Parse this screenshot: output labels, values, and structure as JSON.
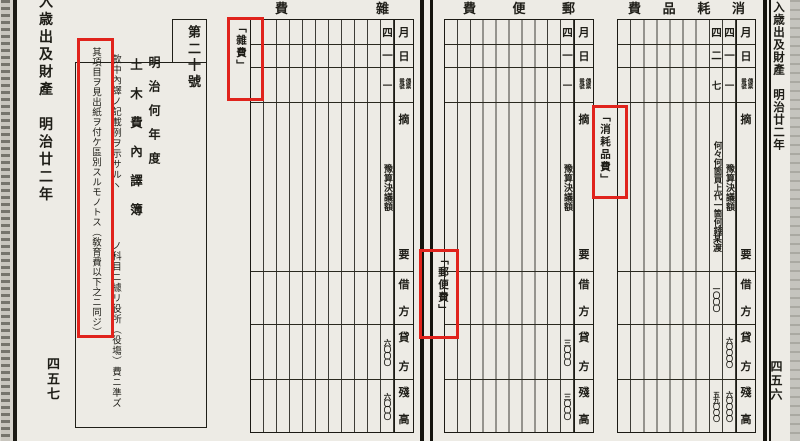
{
  "book": {
    "left_margin": {
      "edge_title": "入歳出及財產　明治廿二年",
      "page_number": "四五七"
    },
    "right_margin": {
      "edge_title": "入歳出及財產　明治廿二年",
      "page_number": "四五六"
    },
    "form_number": "第二十號",
    "fiscal_year": "明治何年度",
    "form_title": "土木費內譯簿",
    "note_column_1": "款中內譯ノ記載例ヲ示サルヽ𪜈豫算決定ノ科目ニ據リ役所（役塲）費ニ準ズ",
    "note_column_2": "其項目ヲ見出紙ヲ付ケ區別スルモノトス（敎育費以下之ニ同ジ）"
  },
  "ledger_headers": {
    "month": "月",
    "day": "日",
    "voucher_no": "傳票番號",
    "description": "摘要",
    "debit": "借方",
    "credit": "貸方",
    "balance": "殘高"
  },
  "tables": [
    {
      "title": "雜費",
      "tab_label": "「雜費」",
      "entries": [
        {
          "month": "四",
          "day": "一",
          "voucher": "一",
          "description": "豫算決議額",
          "credit": "六〇〇〇",
          "balance": "六〇〇〇"
        }
      ]
    },
    {
      "title": "郵便費",
      "tab_label": "「郵便費」",
      "entries": [
        {
          "month": "四",
          "day": "一",
          "voucher": "一",
          "description": "豫算決議額",
          "credit": "三〇〇〇",
          "balance": "三〇〇〇"
        }
      ]
    },
    {
      "title": "消耗品費",
      "tab_label": "「消耗品費」",
      "entries": [
        {
          "month": "四",
          "day": "一",
          "voucher": "一",
          "description": "豫算決議額",
          "credit": "六〇〇〇〇",
          "balance": "六〇〇〇〇"
        },
        {
          "month": "四",
          "day": "二",
          "voucher": "七",
          "description": "何々何箇買上代一箇何錢",
          "description2": "某渡",
          "debit": "一〇〇〇",
          "balance": "五九〇〇〇"
        }
      ]
    }
  ],
  "highlight_color": "#e0231c"
}
